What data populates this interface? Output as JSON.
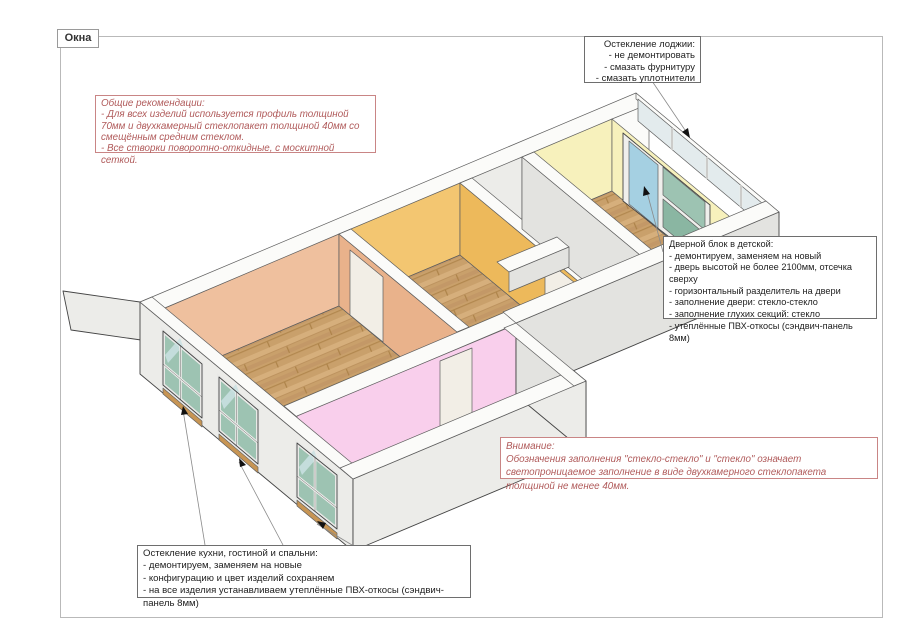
{
  "page": {
    "tag": "Окна"
  },
  "callouts": {
    "loggia": {
      "text": "Остекление лоджии:\n- не демонтировать\n- смазать фурнитуру\n- смазать уплотнители"
    },
    "general": {
      "text": "Общие рекомендации:\n- Для всех изделий используется профиль толщиной 70мм и двухкамерный стеклопакет толщиной 40мм со смещённым средним стеклом.\n- Все створки поворотно-откидные, с москитной сеткой."
    },
    "door_block": {
      "text": "Дверной блок в детской:\n- демонтируем, заменяем на новый\n- дверь высотой не более 2100мм, отсечка сверху\n- горизонтальный разделитель на двери\n- заполнение двери: стекло-стекло\n- заполнение глухих секций: стекло\n- утеплённые ПВХ-откосы (сэндвич-панель 8мм)"
    },
    "attention": {
      "text": "Внимание:\nОбозначения заполнения \"стекло-стекло\" и \"стекло\" означает светопроницаемое заполнение в виде двухкамерного стеклопакета толщиной не менее 40мм."
    },
    "windows": {
      "text": "Остекление кухни, гостиной и спальни:\n- демонтируем, заменяем на новые\n- конфигурацию и цвет изделий сохраняем\n- на все изделия устанавливаем утеплённые ПВХ-откосы (сэндвич-панель 8мм)"
    }
  },
  "colors": {
    "wallOuter": "#ECECE9",
    "wallOuterDark": "#E3E3E0",
    "wallTop": "#FBFBF9",
    "peach": "#EFC09E",
    "peachDark": "#E9B28B",
    "pink": "#F9CFEC",
    "pinkDark": "#F2BCE1",
    "amber": "#F3C671",
    "amberDark": "#EDB95B",
    "yellow": "#F7F1BC",
    "grayFloor": "#ECECEA",
    "wood1": "#C9A06B",
    "wood2": "#BD935F",
    "wood3": "#D6AF7C",
    "glassTeal": "#9DC3B2",
    "glassTealDark": "#8AB6A2",
    "glassBlue": "#A5D0E2",
    "sill": "#C79554",
    "redBorder": "#C98585",
    "redText": "#B05A5A"
  }
}
